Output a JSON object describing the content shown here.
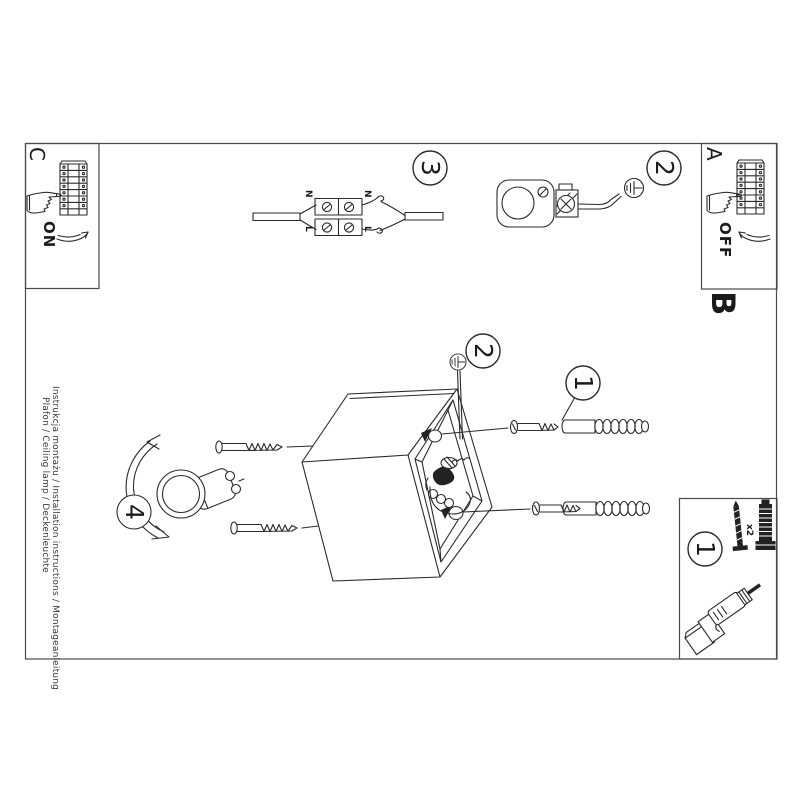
{
  "document": {
    "type": "installation-instruction-sheet",
    "sections": {
      "a": {
        "label": "A",
        "state": "OFF"
      },
      "b": {
        "label": "B"
      },
      "c": {
        "label": "C",
        "state": "ON"
      }
    },
    "steps": {
      "one": "1",
      "two": "2",
      "three": "3",
      "four": "4"
    },
    "parts": {
      "step": "1",
      "quantity": "x2"
    },
    "wiring": {
      "neutral": "N",
      "live": "L"
    },
    "footer": {
      "line1": "Instrukcja montażu / Installation instructions / Montageanleitung",
      "line2": "Plafon / Ceiling lamp / Deckenleuchte"
    },
    "colors": {
      "ink": "#2b2b2b",
      "frame": "#4a4a4a",
      "paper": "#ffffff"
    }
  }
}
